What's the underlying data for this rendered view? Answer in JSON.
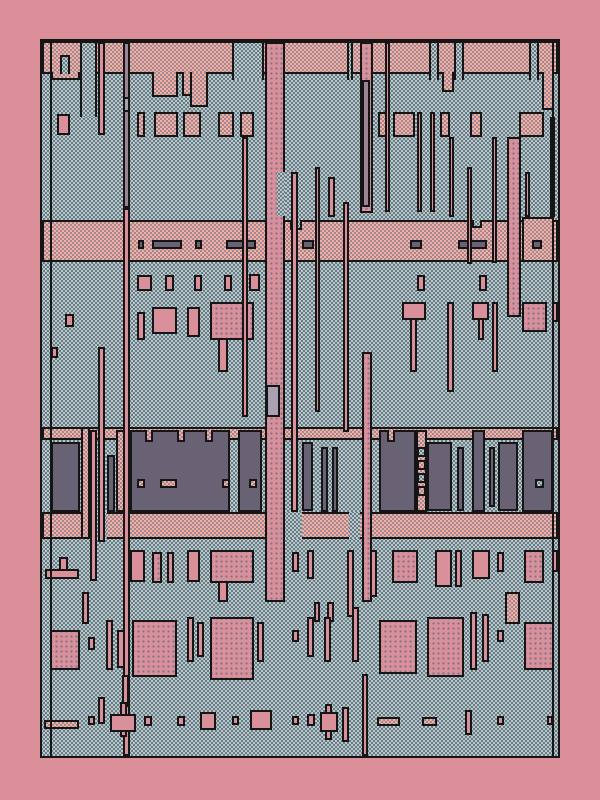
{
  "palette": {
    "margin": "#DB8F99",
    "outline": "#151515",
    "blue_base": "#AECCCA",
    "blue_dot": "#6E6F7E",
    "salmon_base": "#F6AFA1",
    "salmon_dot": "#9A8693",
    "pink_solid": "#D9909A",
    "pink_grid_dot": "#7B7287",
    "dark_slab": "#686274",
    "mauve": "#9D8396",
    "light_mauve": "#A9A1B1"
  },
  "canvas": {
    "x": 40,
    "y": 39,
    "w": 520,
    "h": 719
  },
  "shapes": [
    [
      "top-band",
      "salmon",
      0,
      0,
      516,
      33,
      1
    ],
    [
      "band-tab",
      "salmon",
      9,
      31,
      29,
      8,
      2
    ],
    [
      "band-tab",
      "salmon",
      110,
      31,
      26,
      25,
      2
    ],
    [
      "band-tab",
      "salmon",
      140,
      31,
      26,
      24,
      2
    ],
    [
      "band-tab",
      "salmon",
      148,
      31,
      18,
      35,
      2
    ],
    [
      "band-tab",
      "salmon",
      400,
      31,
      12,
      20,
      2
    ],
    [
      "band-tab",
      "salmon",
      500,
      31,
      12,
      38,
      2
    ],
    [
      "band-tower",
      "blue",
      38,
      0,
      17,
      76,
      3
    ],
    [
      "band-tower",
      "blue",
      190,
      0,
      32,
      39,
      3
    ],
    [
      "band-tower",
      "blue",
      305,
      0,
      6,
      39,
      3
    ],
    [
      "band-tower",
      "blue",
      387,
      0,
      10,
      39,
      3
    ],
    [
      "band-tower",
      "blue",
      412,
      0,
      10,
      39,
      3
    ],
    [
      "band-tower",
      "blue",
      487,
      0,
      10,
      39,
      3
    ],
    [
      "band-notch",
      "blue",
      18,
      14,
      10,
      19,
      3
    ],
    [
      "box-row-cell",
      "salmon",
      95,
      71,
      8,
      25,
      1
    ],
    [
      "box-row-cell",
      "salmon",
      112,
      71,
      24,
      25,
      1
    ],
    [
      "box-row-cell",
      "salmon",
      141,
      71,
      18,
      25,
      1
    ],
    [
      "box-row-cell",
      "salmon",
      176,
      71,
      16,
      25,
      1
    ],
    [
      "box-row-cell",
      "salmon",
      198,
      71,
      14,
      25,
      1
    ],
    [
      "box-row-cell",
      "salmon",
      336,
      71,
      10,
      25,
      1
    ],
    [
      "box-row-cell",
      "salmon",
      351,
      71,
      22,
      25,
      1
    ],
    [
      "box-row-cell",
      "salmon",
      398,
      71,
      10,
      25,
      1
    ],
    [
      "box-row-cell",
      "salmon",
      428,
      71,
      12,
      25,
      1
    ],
    [
      "box-row-cell",
      "salmon",
      477,
      71,
      25,
      25,
      1
    ],
    [
      "dash-band",
      "salmon",
      0,
      179,
      516,
      42,
      1
    ],
    [
      "band-block",
      "salmon",
      480,
      176,
      32,
      45,
      1
    ],
    [
      "band-notch",
      "blue",
      248,
      179,
      12,
      10,
      2
    ],
    [
      "band-notch",
      "blue",
      430,
      179,
      10,
      8,
      2
    ],
    [
      "dash",
      "dark",
      96,
      199,
      6,
      9,
      1
    ],
    [
      "dash",
      "dark",
      110,
      199,
      30,
      9,
      1
    ],
    [
      "dash",
      "dark",
      153,
      199,
      7,
      9,
      1
    ],
    [
      "dash",
      "dark",
      184,
      199,
      30,
      9,
      1
    ],
    [
      "dash",
      "dark",
      260,
      199,
      12,
      9,
      1
    ],
    [
      "dash",
      "dark",
      368,
      199,
      12,
      9,
      1
    ],
    [
      "dash",
      "dark",
      416,
      199,
      29,
      9,
      1
    ],
    [
      "dash",
      "dark",
      490,
      199,
      10,
      9,
      1
    ],
    [
      "chip-sq",
      "pink",
      95,
      234,
      15,
      16,
      1
    ],
    [
      "chip-sq",
      "pink",
      123,
      234,
      9,
      16,
      1
    ],
    [
      "chip-sq",
      "pink",
      152,
      234,
      8,
      16,
      1
    ],
    [
      "chip-sq",
      "pink",
      182,
      234,
      8,
      16,
      1
    ],
    [
      "chip-sq",
      "pink",
      207,
      233,
      11,
      17,
      1
    ],
    [
      "chip-sq",
      "pink",
      375,
      234,
      8,
      16,
      1
    ],
    [
      "chip-sq",
      "pink",
      437,
      234,
      8,
      16,
      1
    ],
    [
      "mid-bar",
      "pink",
      95,
      271,
      8,
      28,
      1
    ],
    [
      "mid-block",
      "pink",
      110,
      266,
      25,
      27,
      1
    ],
    [
      "mid-arrow",
      "pink",
      145,
      266,
      13,
      30,
      1
    ],
    [
      "mid-cross",
      "pinkdot",
      168,
      261,
      44,
      38,
      1
    ],
    [
      "mid-stem",
      "pink",
      176,
      297,
      10,
      34,
      1
    ],
    [
      "mid-tcap",
      "pink",
      360,
      261,
      24,
      18,
      1
    ],
    [
      "mid-tstem",
      "pink",
      368,
      277,
      7,
      54,
      1
    ],
    [
      "mid-bar",
      "pink",
      405,
      261,
      7,
      90,
      1
    ],
    [
      "mid-tcap",
      "pink",
      430,
      261,
      17,
      18,
      1
    ],
    [
      "mid-tstem",
      "pink",
      436,
      277,
      6,
      22,
      1
    ],
    [
      "mid-tcap",
      "pinkdot",
      480,
      261,
      25,
      30,
      1
    ],
    [
      "mid-bar",
      "pink",
      510,
      261,
      6,
      20,
      1
    ],
    [
      "mid-sq",
      "pink",
      23,
      273,
      9,
      13,
      1
    ],
    [
      "mid-sq",
      "pink",
      9,
      306,
      7,
      11,
      1
    ],
    [
      "comp-top-strip",
      "salmon",
      0,
      386,
      516,
      13,
      1
    ],
    [
      "comp-bottom-strip",
      "salmon",
      0,
      471,
      516,
      27,
      1
    ],
    [
      "comp-gap",
      "blue",
      47,
      471,
      18,
      27,
      0
    ],
    [
      "comp-gap",
      "blue",
      243,
      471,
      17,
      27,
      0
    ],
    [
      "comp-gap",
      "blue",
      307,
      471,
      11,
      27,
      0
    ],
    [
      "comp-col",
      "salmon",
      39,
      386,
      9,
      112,
      1
    ],
    [
      "comp-col",
      "salmon",
      74,
      389,
      14,
      82,
      1
    ],
    [
      "comp-col",
      "salmon",
      374,
      389,
      11,
      82,
      1
    ],
    [
      "dark-slab",
      "dark",
      9,
      401,
      29,
      70,
      1
    ],
    [
      "dark-slab",
      "dark",
      65,
      414,
      8,
      57,
      1
    ],
    [
      "dark-slab",
      "dark",
      88,
      389,
      100,
      82,
      1
    ],
    [
      "slab-notch",
      "salmon",
      103,
      389,
      8,
      12,
      2
    ],
    [
      "slab-notch",
      "salmon",
      135,
      389,
      8,
      12,
      2
    ],
    [
      "slab-notch",
      "salmon",
      163,
      389,
      8,
      12,
      2
    ],
    [
      "slab-hole",
      "salmon",
      95,
      438,
      8,
      9,
      1
    ],
    [
      "slab-hole",
      "salmon",
      118,
      438,
      17,
      9,
      1
    ],
    [
      "slab-hole",
      "salmon",
      180,
      438,
      8,
      9,
      1
    ],
    [
      "dark-slab",
      "dark",
      196,
      389,
      24,
      82,
      1
    ],
    [
      "slab-hole",
      "salmon",
      207,
      438,
      8,
      9,
      1
    ],
    [
      "dark-slab",
      "dark",
      260,
      401,
      11,
      69,
      1
    ],
    [
      "dark-slab",
      "dark",
      279,
      406,
      7,
      65,
      1
    ],
    [
      "dark-slab",
      "dark",
      290,
      406,
      6,
      65,
      1
    ],
    [
      "dark-slab",
      "dark",
      337,
      389,
      37,
      82,
      1
    ],
    [
      "slab-notch",
      "salmon",
      345,
      389,
      8,
      12,
      2
    ],
    [
      "pin",
      "blue",
      375,
      406,
      9,
      10,
      1
    ],
    [
      "pin",
      "salmon",
      375,
      419,
      9,
      10,
      1
    ],
    [
      "pin",
      "blue",
      375,
      432,
      9,
      10,
      1
    ],
    [
      "pin",
      "salmon",
      375,
      445,
      9,
      10,
      1
    ],
    [
      "dark-slab",
      "dark",
      385,
      401,
      25,
      69,
      1
    ],
    [
      "dark-slab",
      "dark",
      415,
      406,
      7,
      64,
      1
    ],
    [
      "dark-slab",
      "dark",
      430,
      389,
      13,
      82,
      1
    ],
    [
      "dark-slab",
      "dark",
      447,
      406,
      6,
      60,
      1
    ],
    [
      "dark-slab",
      "dark",
      456,
      401,
      20,
      69,
      1
    ],
    [
      "dark-slab",
      "dark",
      480,
      389,
      31,
      82,
      1
    ],
    [
      "slab-hole",
      "blue",
      493,
      438,
      9,
      9,
      1
    ],
    [
      "vbar",
      "pink",
      56,
      1,
      7,
      93,
      1
    ],
    [
      "vbar",
      "pink",
      56,
      306,
      7,
      195,
      1
    ],
    [
      "vbar",
      "pink",
      56,
      656,
      7,
      27,
      1
    ],
    [
      "vbar",
      "mauve",
      81,
      1,
      7,
      166,
      1
    ],
    [
      "vbar-seg",
      "litemauve",
      81,
      56,
      7,
      15,
      1
    ],
    [
      "vbar",
      "pink",
      81,
      167,
      7,
      548,
      1
    ],
    [
      "vbar",
      "pink",
      200,
      96,
      6,
      280,
      1
    ],
    [
      "vcol",
      "pinkdot",
      223,
      1,
      20,
      560,
      1
    ],
    [
      "vcol-notch",
      "blue",
      235,
      131,
      8,
      44,
      0
    ],
    [
      "vcol-inset",
      "litemauve",
      224,
      344,
      14,
      32,
      1
    ],
    [
      "vbar",
      "pink",
      249,
      131,
      7,
      340,
      1
    ],
    [
      "vbar",
      "pink",
      273,
      126,
      5,
      245,
      1
    ],
    [
      "vbar",
      "pink",
      286,
      136,
      7,
      40,
      1
    ],
    [
      "vbar",
      "pink",
      301,
      161,
      6,
      230,
      1
    ],
    [
      "vcol",
      "pinkdot",
      318,
      1,
      13,
      171,
      1
    ],
    [
      "vcol-inset",
      "mauve",
      320,
      39,
      8,
      127,
      1
    ],
    [
      "vcol",
      "pinkdot",
      320,
      311,
      10,
      250,
      1
    ],
    [
      "vbar",
      "pink",
      343,
      1,
      5,
      170,
      1
    ],
    [
      "vbar",
      "pink",
      375,
      71,
      5,
      100,
      1
    ],
    [
      "vbar",
      "pink",
      388,
      71,
      5,
      100,
      1
    ],
    [
      "vbar",
      "pink",
      407,
      96,
      5,
      80,
      1
    ],
    [
      "vbar",
      "pink",
      425,
      126,
      5,
      97,
      1
    ],
    [
      "vbar",
      "pink",
      450,
      96,
      5,
      126,
      1
    ],
    [
      "vbar",
      "pink",
      450,
      261,
      6,
      70,
      1
    ],
    [
      "vcol",
      "pinkdot",
      465,
      96,
      14,
      180,
      1
    ],
    [
      "vbar",
      "pink",
      483,
      131,
      5,
      45,
      1
    ],
    [
      "vbar",
      "pink",
      508,
      76,
      5,
      100,
      1
    ],
    [
      "vbar",
      "pink",
      48,
      389,
      7,
      151,
      1
    ],
    [
      "edge-arrow",
      "pink",
      15,
      73,
      13,
      21,
      1
    ],
    [
      "edge-l",
      "pink",
      17,
      516,
      9,
      14,
      1
    ],
    [
      "edge-l",
      "pink",
      3,
      528,
      34,
      10,
      1
    ],
    [
      "low-block",
      "pink",
      88,
      509,
      15,
      32,
      1
    ],
    [
      "low-block",
      "pinkdot",
      110,
      511,
      10,
      31,
      1
    ],
    [
      "low-block",
      "pinkdot",
      125,
      511,
      7,
      31,
      1
    ],
    [
      "low-block",
      "pink",
      145,
      509,
      13,
      32,
      1
    ],
    [
      "low-block",
      "pinkdot",
      168,
      509,
      44,
      33,
      1
    ],
    [
      "low-stem",
      "pink",
      176,
      540,
      10,
      21,
      1
    ],
    [
      "low-block",
      "pink",
      250,
      511,
      7,
      20,
      1
    ],
    [
      "low-block",
      "pink",
      265,
      509,
      7,
      29,
      1
    ],
    [
      "low-bar",
      "pink",
      305,
      509,
      7,
      67,
      1
    ],
    [
      "low-bar",
      "pink",
      328,
      509,
      7,
      47,
      1
    ],
    [
      "low-block",
      "pinkdot",
      350,
      509,
      26,
      33,
      1
    ],
    [
      "low-block",
      "pink",
      393,
      509,
      17,
      37,
      1
    ],
    [
      "low-bar",
      "pink",
      413,
      509,
      7,
      37,
      1
    ],
    [
      "low-block",
      "pink",
      430,
      509,
      18,
      29,
      1
    ],
    [
      "low-block",
      "pink",
      455,
      511,
      7,
      20,
      1
    ],
    [
      "low-block",
      "pinkdot",
      482,
      509,
      20,
      33,
      1
    ],
    [
      "low-block",
      "pink",
      510,
      509,
      6,
      22,
      1
    ],
    [
      "mini-bar",
      "pinkdot",
      40,
      551,
      7,
      32,
      1
    ],
    [
      "mini-bar",
      "pinkdot",
      272,
      561,
      6,
      20,
      1
    ],
    [
      "mini-bar",
      "pinkdot",
      285,
      561,
      7,
      20,
      1
    ],
    [
      "mini-block",
      "salmon",
      463,
      551,
      15,
      32,
      1
    ],
    [
      "tree-blob",
      "pinkdot",
      8,
      589,
      30,
      40,
      1
    ],
    [
      "tree-sq",
      "pink",
      46,
      596,
      7,
      13,
      1
    ],
    [
      "tree-bar",
      "pink",
      64,
      579,
      7,
      50,
      1
    ],
    [
      "tree-bar",
      "pink",
      75,
      589,
      8,
      38,
      1
    ],
    [
      "tree-block",
      "pinkdot",
      90,
      579,
      45,
      57,
      1
    ],
    [
      "tree-stem",
      "pink",
      80,
      634,
      7,
      32,
      1
    ],
    [
      "tree-bar",
      "pink",
      145,
      576,
      7,
      45,
      1
    ],
    [
      "tree-bar",
      "pink",
      155,
      581,
      7,
      35,
      1
    ],
    [
      "tree-block",
      "pinkdot",
      168,
      576,
      44,
      63,
      1
    ],
    [
      "tree-bar",
      "pink",
      215,
      581,
      7,
      40,
      1
    ],
    [
      "tree-sq",
      "pink",
      250,
      589,
      7,
      12,
      1
    ],
    [
      "tree-bar",
      "pink",
      265,
      576,
      7,
      40,
      1
    ],
    [
      "tree-bar",
      "pink",
      282,
      576,
      7,
      45,
      1
    ],
    [
      "tree-bar",
      "pink",
      310,
      566,
      7,
      55,
      1
    ],
    [
      "tree-block",
      "pinkdot",
      337,
      579,
      38,
      54,
      1
    ],
    [
      "tree-block",
      "pinkdot",
      385,
      576,
      37,
      60,
      1
    ],
    [
      "tree-bar",
      "pink",
      428,
      571,
      7,
      58,
      1
    ],
    [
      "tree-bar",
      "pink",
      440,
      573,
      7,
      48,
      1
    ],
    [
      "tree-sq",
      "pink",
      455,
      589,
      7,
      12,
      1
    ],
    [
      "tree-block",
      "pinkdot",
      482,
      581,
      30,
      48,
      1
    ],
    [
      "dot-bar",
      "pink",
      78,
      661,
      7,
      35,
      1
    ],
    [
      "dot-dash",
      "salmon",
      2,
      679,
      35,
      9,
      1
    ],
    [
      "dot-sq",
      "pink",
      46,
      675,
      7,
      9,
      1
    ],
    [
      "dot-cross",
      "pink",
      68,
      673,
      26,
      18,
      1
    ],
    [
      "dot-sq",
      "pink",
      102,
      675,
      8,
      10,
      1
    ],
    [
      "dot-sq",
      "pink",
      135,
      675,
      8,
      10,
      1
    ],
    [
      "dot-l",
      "pink",
      158,
      671,
      16,
      18,
      1
    ],
    [
      "dot-sq",
      "pink",
      190,
      675,
      7,
      9,
      1
    ],
    [
      "dot-step",
      "pink",
      208,
      669,
      22,
      20,
      1
    ],
    [
      "dot-sq",
      "pink",
      250,
      675,
      7,
      9,
      1
    ],
    [
      "dot-sq",
      "pink",
      265,
      673,
      8,
      12,
      1
    ],
    [
      "dot-stem",
      "pink",
      283,
      663,
      7,
      36,
      1
    ],
    [
      "dot-cross",
      "pink",
      278,
      671,
      18,
      20,
      1
    ],
    [
      "dot-bar",
      "pink",
      300,
      666,
      7,
      35,
      1
    ],
    [
      "dot-bar",
      "pink",
      320,
      633,
      6,
      82,
      1
    ],
    [
      "dot-dash",
      "salmon",
      335,
      676,
      23,
      9,
      1
    ],
    [
      "dot-dash",
      "salmon",
      380,
      676,
      15,
      9,
      1
    ],
    [
      "dot-bar",
      "pink",
      423,
      669,
      7,
      25,
      1
    ],
    [
      "dot-sq",
      "pink",
      455,
      675,
      7,
      9,
      1
    ],
    [
      "dot-sq",
      "pink",
      505,
      675,
      6,
      9,
      1
    ],
    [
      "gutter-line",
      "line",
      8,
      0,
      2,
      715,
      0
    ],
    [
      "gutter-line",
      "line",
      510,
      0,
      2,
      715,
      0
    ]
  ]
}
